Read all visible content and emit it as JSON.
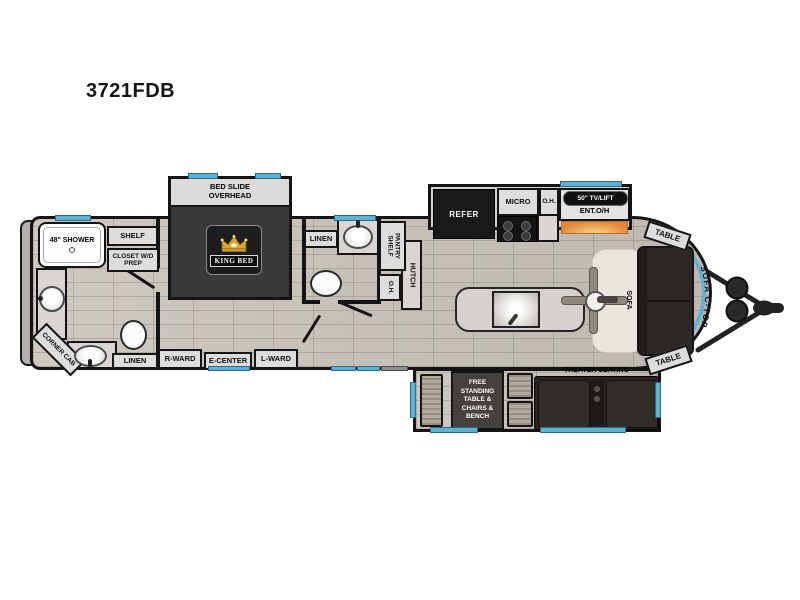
{
  "title": "3721FDB",
  "colors": {
    "window_blue": "#5fb0d2",
    "fireplace_orange": "#e0883a",
    "wall_black": "#141414",
    "floor_tan": "#c8c2b9",
    "bed_slide_dark": "#3a3a3d",
    "furniture_dark_brown": "#2c2824",
    "crown_gold": "#d9a82a"
  },
  "front_bath": {
    "shower": "48\" SHOWER",
    "shelf": "SHELF",
    "closet": "CLOSET W/D PREP",
    "corner_cab": "CORNER CAB",
    "linen": "LINEN"
  },
  "bedroom": {
    "slide_label": "BED SLIDE OVERHEAD",
    "bed_label": "KING BED",
    "right_wardrobe": "R-WARD",
    "entertainment_center": "E-CENTER",
    "left_wardrobe": "L-WARD"
  },
  "mid_bath": {
    "linen": "LINEN",
    "pantry_shelf": "PANTRY SHELF",
    "overhead": "O.H.",
    "hutch": "HUTCH"
  },
  "kitchen": {
    "refrigerator": "REFER",
    "microwave": "MICRO",
    "overhead": "O.H.",
    "tv_lift": "50\" TV/LIFT",
    "entertainment_overhead": "ENT.O/H"
  },
  "living": {
    "table_rear_top": "TABLE",
    "table_rear_bottom": "TABLE",
    "sofa": "SOFA",
    "sofa_countertop": "SOFA C-TOP",
    "theater": "THEATER SEATING",
    "dinette": "FREE STANDING TABLE & CHAIRS & BENCH"
  }
}
